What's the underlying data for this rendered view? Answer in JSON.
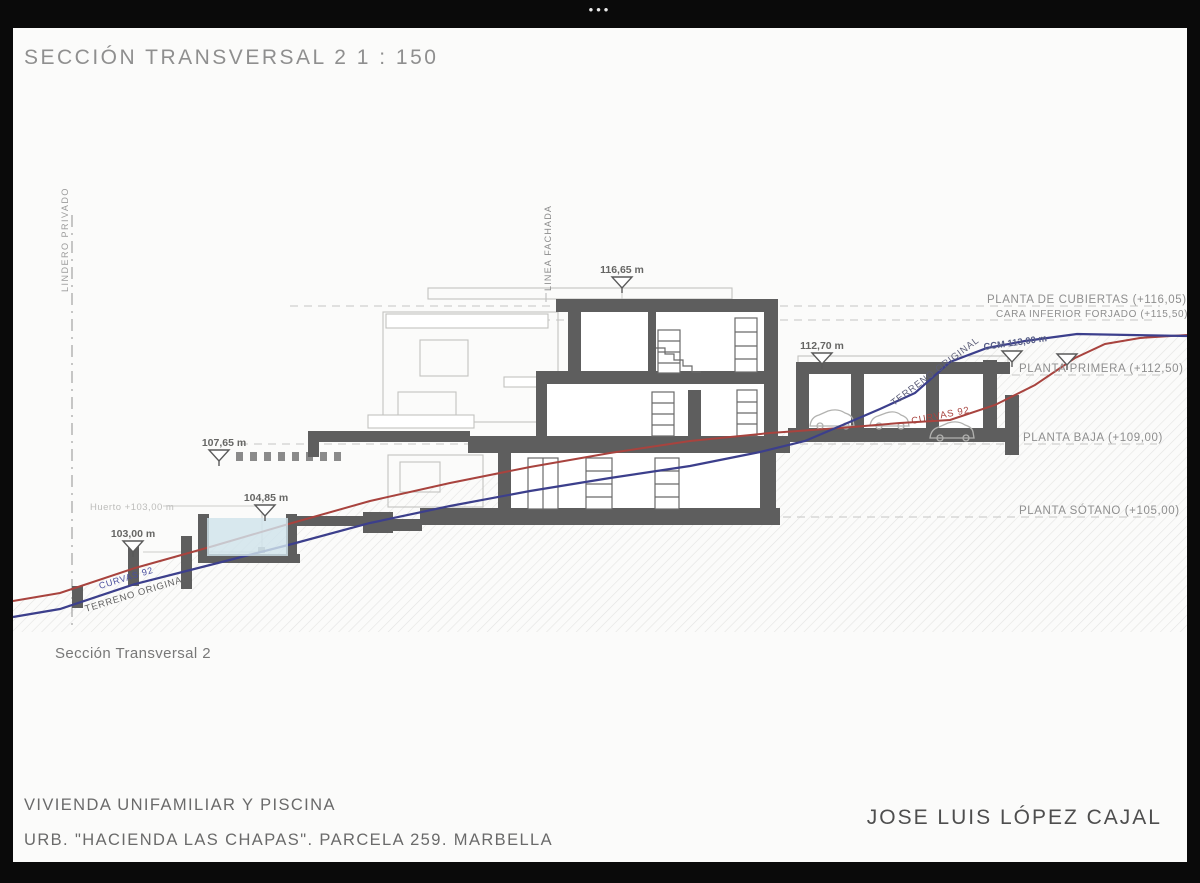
{
  "window": {
    "dots": "•••"
  },
  "sheet": {
    "title": "SECCIÓN TRANSVERSAL 2 1 : 150",
    "caption": "Sección Transversal 2",
    "footer": {
      "project_line1": "VIVIENDA UNIFAMILIAR Y PISCINA",
      "project_line2": "URB. \"HACIENDA LAS CHAPAS\". PARCELA 259. MARBELLA",
      "architect": "JOSE LUIS LÓPEZ CAJAL"
    }
  },
  "drawing": {
    "boundaries": {
      "left_boundary": "LINDERO PRIVADO",
      "facade_line": "LINEA FACHADA"
    },
    "levels": [
      {
        "name": "planta-cubiertas",
        "label": "PLANTA DE CUBIERTAS (+116,05)"
      },
      {
        "name": "cara-inferior-forjado",
        "label": "CARA INFERIOR FORJADO (+115,50)"
      },
      {
        "name": "planta-primera",
        "label": "PLANTA PRIMERA (+112,50)"
      },
      {
        "name": "planta-baja",
        "label": "PLANTA BAJA (+109,00)"
      },
      {
        "name": "planta-sotano",
        "label": "PLANTA SÓTANO (+105,00)"
      }
    ],
    "spot_elevations": [
      {
        "name": "roof-level",
        "label": "116,65 m"
      },
      {
        "name": "garage-roof-level",
        "label": "112,70 m"
      },
      {
        "name": "terrace-level",
        "label": "107,65 m"
      },
      {
        "name": "pool-level",
        "label": "104,85 m"
      },
      {
        "name": "garden-level",
        "label": "103,00 m"
      },
      {
        "name": "ccm-level",
        "label": "CCM 113,00 m"
      }
    ],
    "annotations": {
      "huerto": "Huerto +103,00 m",
      "terreno_original_left": "TERRENO ORIGINAL",
      "curvas_left": "CURVAS 92",
      "terreno_original_right": "TERRENO ORIGINAL",
      "curvas_right": "CURVAS 92"
    }
  },
  "colors": {
    "terrain_original": "#3c3f8c",
    "terrain_curvas": "#a8433e",
    "pool_water": "#cfe3ec",
    "cut_elements": "#5e5e5e",
    "background_lines": "#c2c2c2",
    "label_gray": "#8e8e8e"
  }
}
